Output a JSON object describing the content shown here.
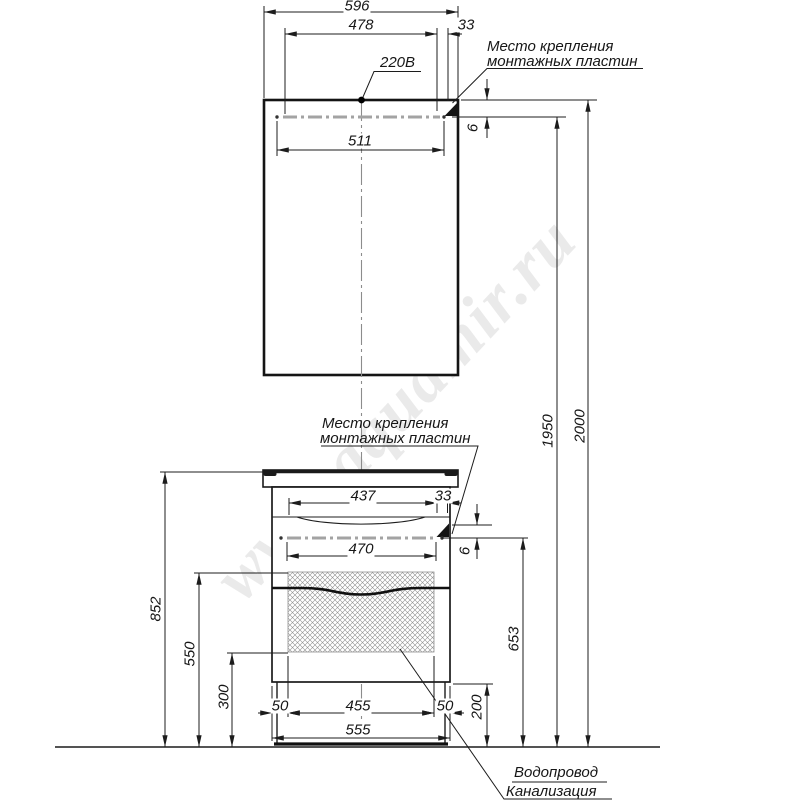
{
  "watermark": "www.aquamir.ru",
  "labels": {
    "outlet": "220В",
    "mount_line1": "Место крепления",
    "mount_line2": "монтажных пластин",
    "utilities_line1": "Водопровод",
    "utilities_line2": "Канализация"
  },
  "dims": {
    "mirror_width": "596",
    "mirror_mount_span": "478",
    "mirror_mount_edge": "33",
    "mirror_plate": "511",
    "mirror_gap": "6",
    "mount_height": "1950",
    "total_height": "2000",
    "vanity_mount_span": "437",
    "vanity_mount_edge": "33",
    "vanity_plate": "470",
    "vanity_gap": "6",
    "vanity_height": "852",
    "hatch_top": "550",
    "hatch_bottom": "300",
    "inset_left": "50",
    "leg_span": "455",
    "inset_right": "50",
    "clearance": "200",
    "plate_height": "653",
    "cabinet_width": "555"
  },
  "colors": {
    "line": "#1c1c1c",
    "mount_plate_gray": "#a3a3a3",
    "hatch_gray": "#8f8f8f"
  }
}
